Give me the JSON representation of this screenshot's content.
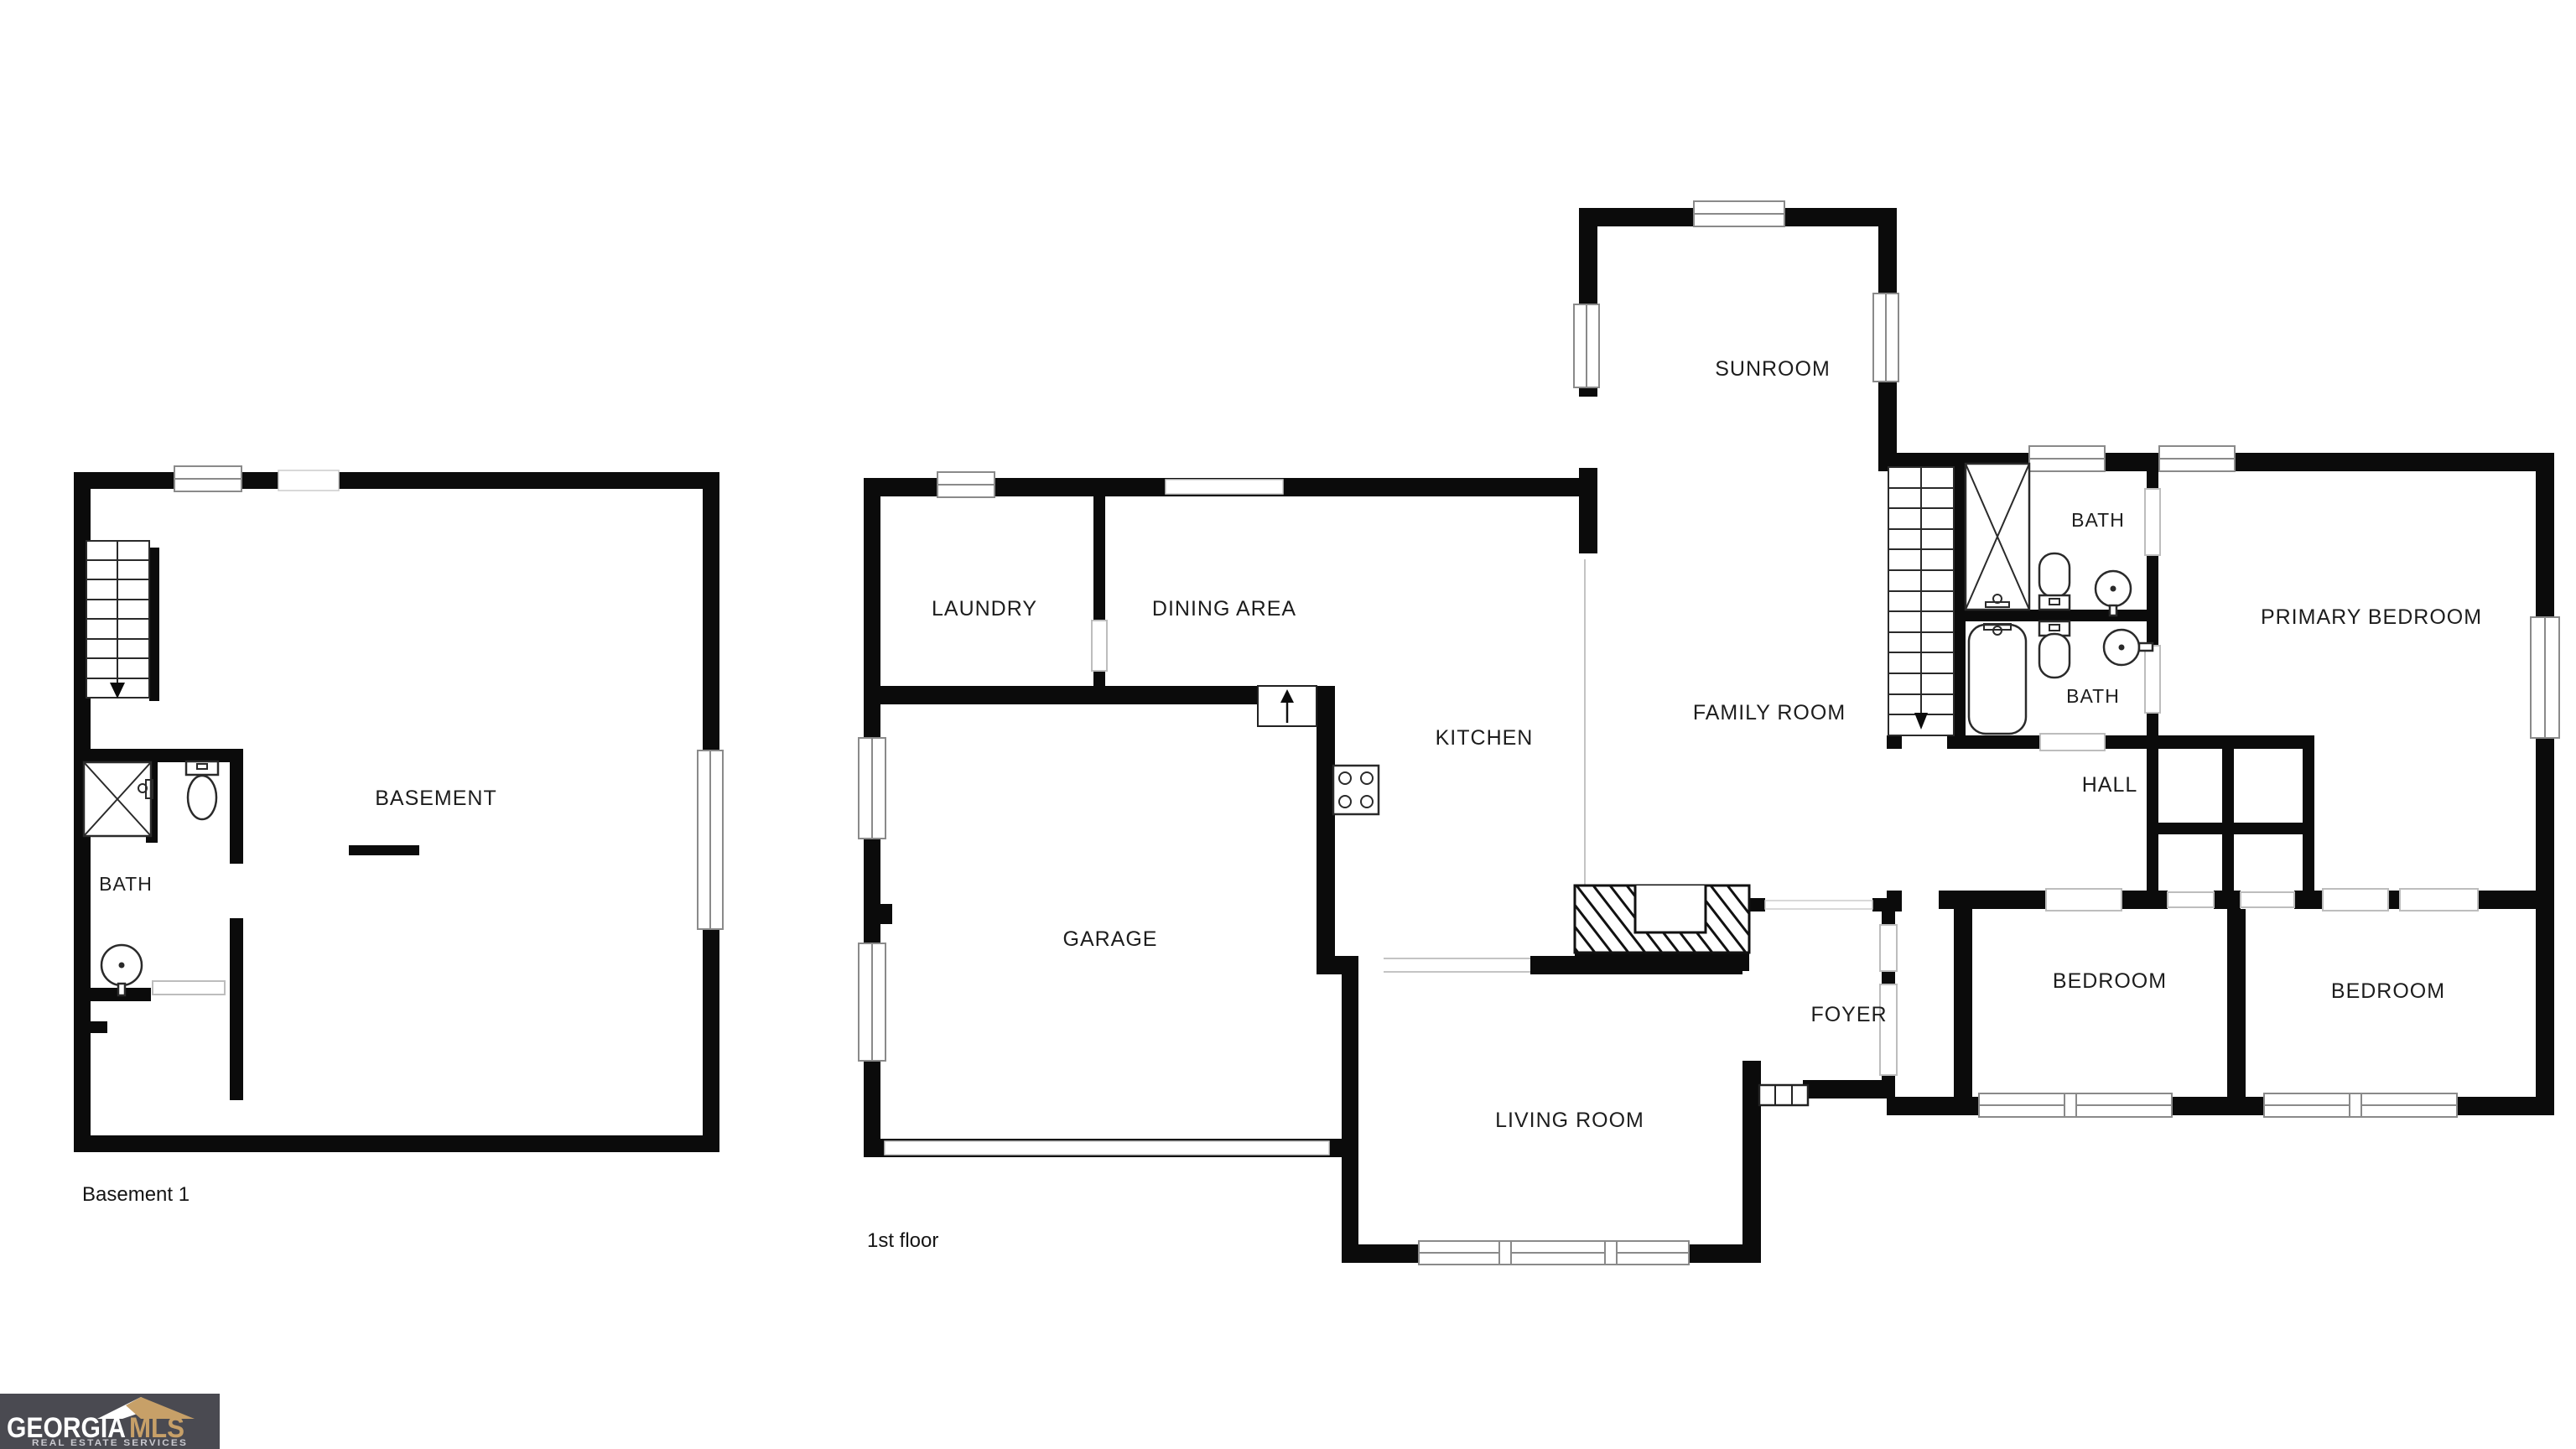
{
  "document": {
    "background": "#ffffff"
  },
  "basement_plan": {
    "caption": "Basement 1",
    "rooms": {
      "basement": "BASEMENT",
      "bath": "BATH"
    }
  },
  "first_floor_plan": {
    "caption": "1st floor",
    "rooms": {
      "sunroom": "SUNROOM",
      "laundry": "LAUNDRY",
      "dining_area": "DINING AREA",
      "kitchen": "KITCHEN",
      "family_room": "FAMILY ROOM",
      "garage": "GARAGE",
      "living_room": "LIVING ROOM",
      "foyer": "FOYER",
      "hall": "HALL",
      "bath_upper": "BATH",
      "bath_lower": "BATH",
      "primary_bedroom": "PRIMARY BEDROOM",
      "bedroom_left": "BEDROOM",
      "bedroom_right": "BEDROOM"
    }
  },
  "logo": {
    "brand_primary": "GEORGIA",
    "brand_accent": "MLS",
    "tagline": "REAL ESTATE SERVICES",
    "colors": {
      "background": "#4a4a51",
      "primary_text": "#ffffff",
      "accent_text": "#c7a068",
      "tagline_text": "#c9c9cf"
    }
  }
}
